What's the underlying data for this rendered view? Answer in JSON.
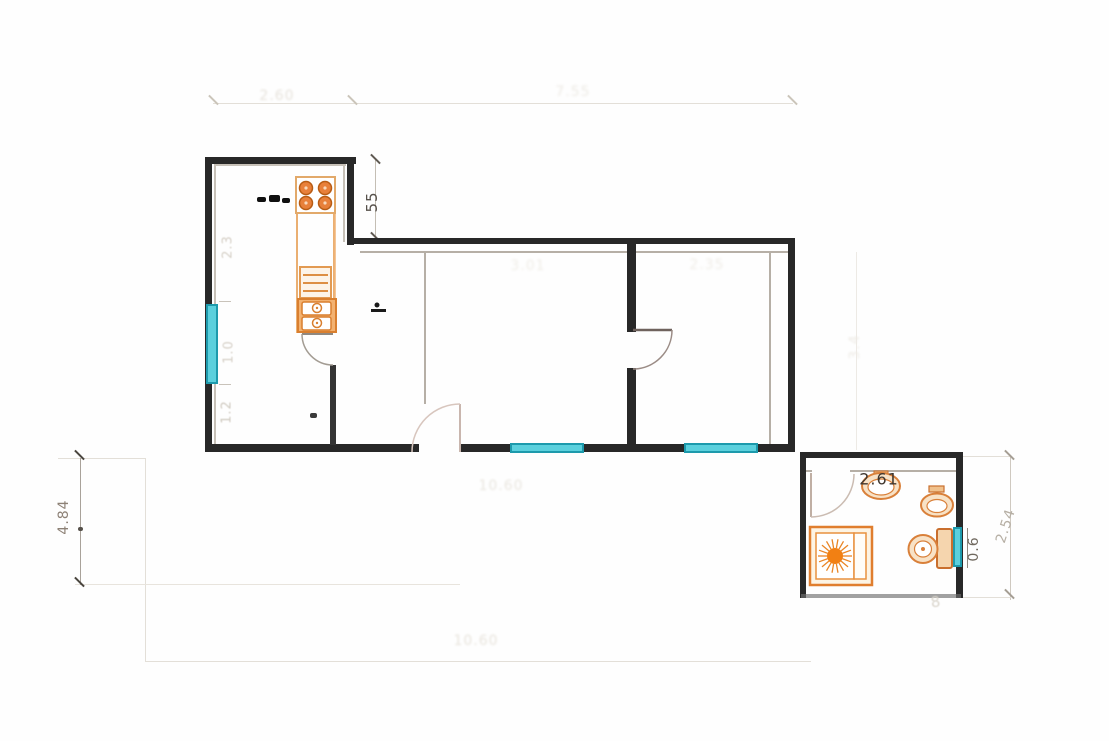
{
  "drawing": {
    "type": "architectural floor plan",
    "labels": {
      "top_left_width": "2.60",
      "top_total_width": "7.55",
      "kitchen_entry_depth": "55",
      "kitchen_seg_upper": "2.3",
      "kitchen_seg_window": "1.0",
      "kitchen_seg_lower": "1.2",
      "left_height": "4.84",
      "living_width": "3.01",
      "bedroom_width": "2.35",
      "hall_width": "10.60",
      "bottom_width": "10.60",
      "bath_width": "2.61",
      "bath_window": "0.6",
      "bath_depth": "2.54",
      "right_height": "3.4",
      "bath_mark": "8"
    },
    "colors": {
      "wall": "#282828",
      "fixture_orange": "#e07e2e",
      "window_cyan": "#5bd0dd",
      "dim_dark": "#3f362e",
      "dim_faint": "#d8d3ca"
    },
    "fixtures": [
      {
        "name": "stove",
        "room": "kitchen"
      },
      {
        "name": "kitchen-drawers",
        "room": "kitchen"
      },
      {
        "name": "kitchen-double-sink",
        "room": "kitchen"
      },
      {
        "name": "wash-basin",
        "room": "bathroom"
      },
      {
        "name": "toilet",
        "room": "bathroom"
      },
      {
        "name": "toilet-with-cistern",
        "room": "bathroom"
      },
      {
        "name": "shower-tray",
        "room": "bathroom"
      }
    ],
    "windows_count": 4,
    "doors_count": 4
  }
}
